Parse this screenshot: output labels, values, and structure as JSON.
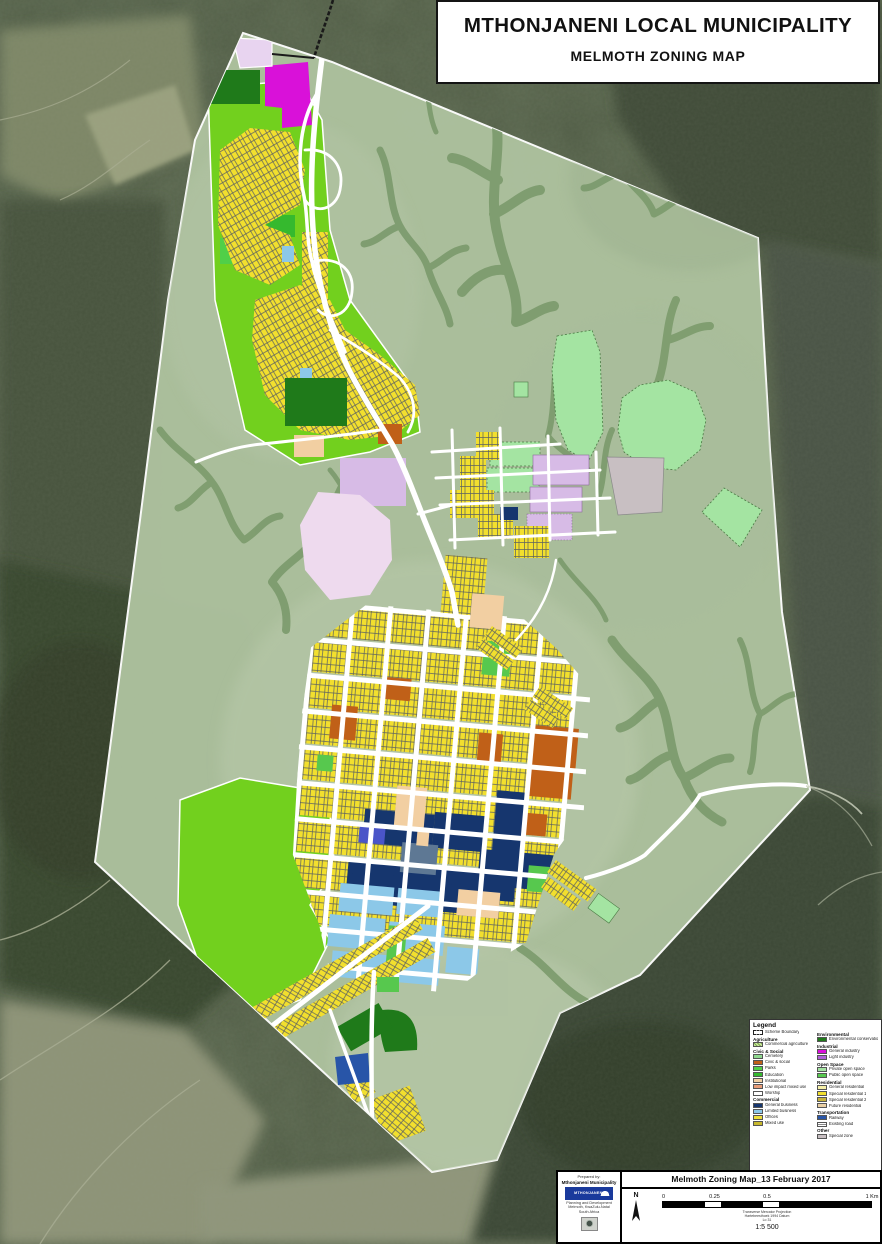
{
  "title_block": {
    "line1": "MTHONJANENI LOCAL MUNICIPALITY",
    "line2": "MELMOTH ZONING MAP"
  },
  "legend": {
    "title": "Legend",
    "columns": [
      {
        "rows": [
          {
            "type": "item",
            "swatch": "boundary",
            "label": "Scheme Boundary"
          },
          {
            "type": "header",
            "label": "Agriculture"
          },
          {
            "type": "item",
            "swatch": "hatch",
            "label": "Commercial agriculture"
          },
          {
            "type": "header",
            "label": "Civic & Social"
          },
          {
            "type": "item",
            "color": "cemetery",
            "label": "Cemetery"
          },
          {
            "type": "item",
            "color": "civic_social",
            "label": "Civic & social"
          },
          {
            "type": "item",
            "color": "parks",
            "label": "Parks"
          },
          {
            "type": "item",
            "color": "education",
            "label": "Education"
          },
          {
            "type": "item",
            "color": "institutional",
            "label": "Institutional"
          },
          {
            "type": "item",
            "color": "low_impact_mixed",
            "label": "Low impact mixed use"
          },
          {
            "type": "item",
            "color": "worship",
            "label": "Worship"
          },
          {
            "type": "header",
            "label": "Commercial"
          },
          {
            "type": "item",
            "color": "general_business",
            "label": "General business"
          },
          {
            "type": "item",
            "color": "limited_business",
            "label": "Limited business"
          },
          {
            "type": "item",
            "color": "offices",
            "label": "Offices"
          },
          {
            "type": "item",
            "color": "mixed_use",
            "label": "Mixed use"
          }
        ]
      },
      {
        "rows": [
          {
            "type": "header",
            "label": "Environmental"
          },
          {
            "type": "item",
            "color": "conservation",
            "label": "Environmental conservation"
          },
          {
            "type": "header",
            "label": "Industrial"
          },
          {
            "type": "item",
            "color": "general_industry",
            "label": "General industry"
          },
          {
            "type": "item",
            "color": "light_industry",
            "label": "Light industry"
          },
          {
            "type": "header",
            "label": "Open Space"
          },
          {
            "type": "item",
            "color": "private_open_space",
            "label": "Private open space"
          },
          {
            "type": "item",
            "color": "public_open_space",
            "label": "Public open space"
          },
          {
            "type": "header",
            "label": "Residential"
          },
          {
            "type": "item",
            "color": "general_residential",
            "label": "General residential"
          },
          {
            "type": "item",
            "color": "special_residential",
            "label": "Special residential 1"
          },
          {
            "type": "item",
            "color": "medium_residential",
            "label": "Special residential 2"
          },
          {
            "type": "item",
            "color": "future_residential",
            "label": "Future residential"
          },
          {
            "type": "header",
            "label": "Transportation"
          },
          {
            "type": "item",
            "color": "railway",
            "label": "Railway"
          },
          {
            "type": "item",
            "swatch": "road",
            "label": "Existing road"
          },
          {
            "type": "header",
            "label": "Other"
          },
          {
            "type": "item",
            "color": "special_zone",
            "label": "Special zone"
          }
        ]
      }
    ]
  },
  "footer": {
    "prepared_by_label": "Prepared by:",
    "prepared_by_name": "Mthonjaneni Municipality",
    "logo_text": "MTHONJANENI",
    "contact_lines": [
      "Planning and Development",
      "Melmoth, KwaZulu-Natal",
      "South Africa"
    ],
    "map_title": "Melmoth Zoning Map_13 February 2017",
    "north_label": "N",
    "scale_ticks": [
      {
        "label": "0",
        "pos": 0
      },
      {
        "label": "0.25",
        "pos": 25
      },
      {
        "label": "0.5",
        "pos": 50
      },
      {
        "label": "1 Km",
        "pos": 100
      }
    ],
    "projection_lines": [
      "Transverse Mercator Projection",
      "Hartebeesthoek 1994 Datum",
      "Lo 31"
    ],
    "scale_ratio": "1:5 500"
  },
  "map": {
    "palette": {
      "scheme_area": "#aec29f",
      "stream": "#7b9a6c",
      "road": "#ffffff",
      "special_residential": "#f2df2e",
      "general_residential": "#f6f0a8",
      "medium_residential": "#c8b43c",
      "future_residential": "#e9cfa4",
      "general_business": "#16366e",
      "limited_business": "#8cc8e8",
      "offices": "#efe03a",
      "mixed_use": "#c8b82e",
      "civic_social": "#c06018",
      "institutional": "#f2cfa2",
      "low_impact_mixed": "#e89c78",
      "worship": "#ffffff",
      "cemetery": "#8fd98f",
      "parks": "#50cf48",
      "education": "#35b92e",
      "public_open_space": "#57c84e",
      "private_open_space": "#a4e4a2",
      "conservation": "#1f7a1a",
      "general_industry": "#d911d9",
      "light_industry": "#b060d8",
      "railway": "#2855a8",
      "special_zone": "#c8bfc2",
      "agriculture": "#cde8a0",
      "lilac": "#d7bbe6",
      "pink_future": "#eedaee",
      "lavender": "#e8d4f0",
      "chartreuse": "#72d01e",
      "blue_violet": "#4a55c8",
      "gray_blue": "#5e7894",
      "sat_base": "#515d46",
      "sat_dark": "#38442f",
      "sat_light": "#8f9476"
    }
  }
}
